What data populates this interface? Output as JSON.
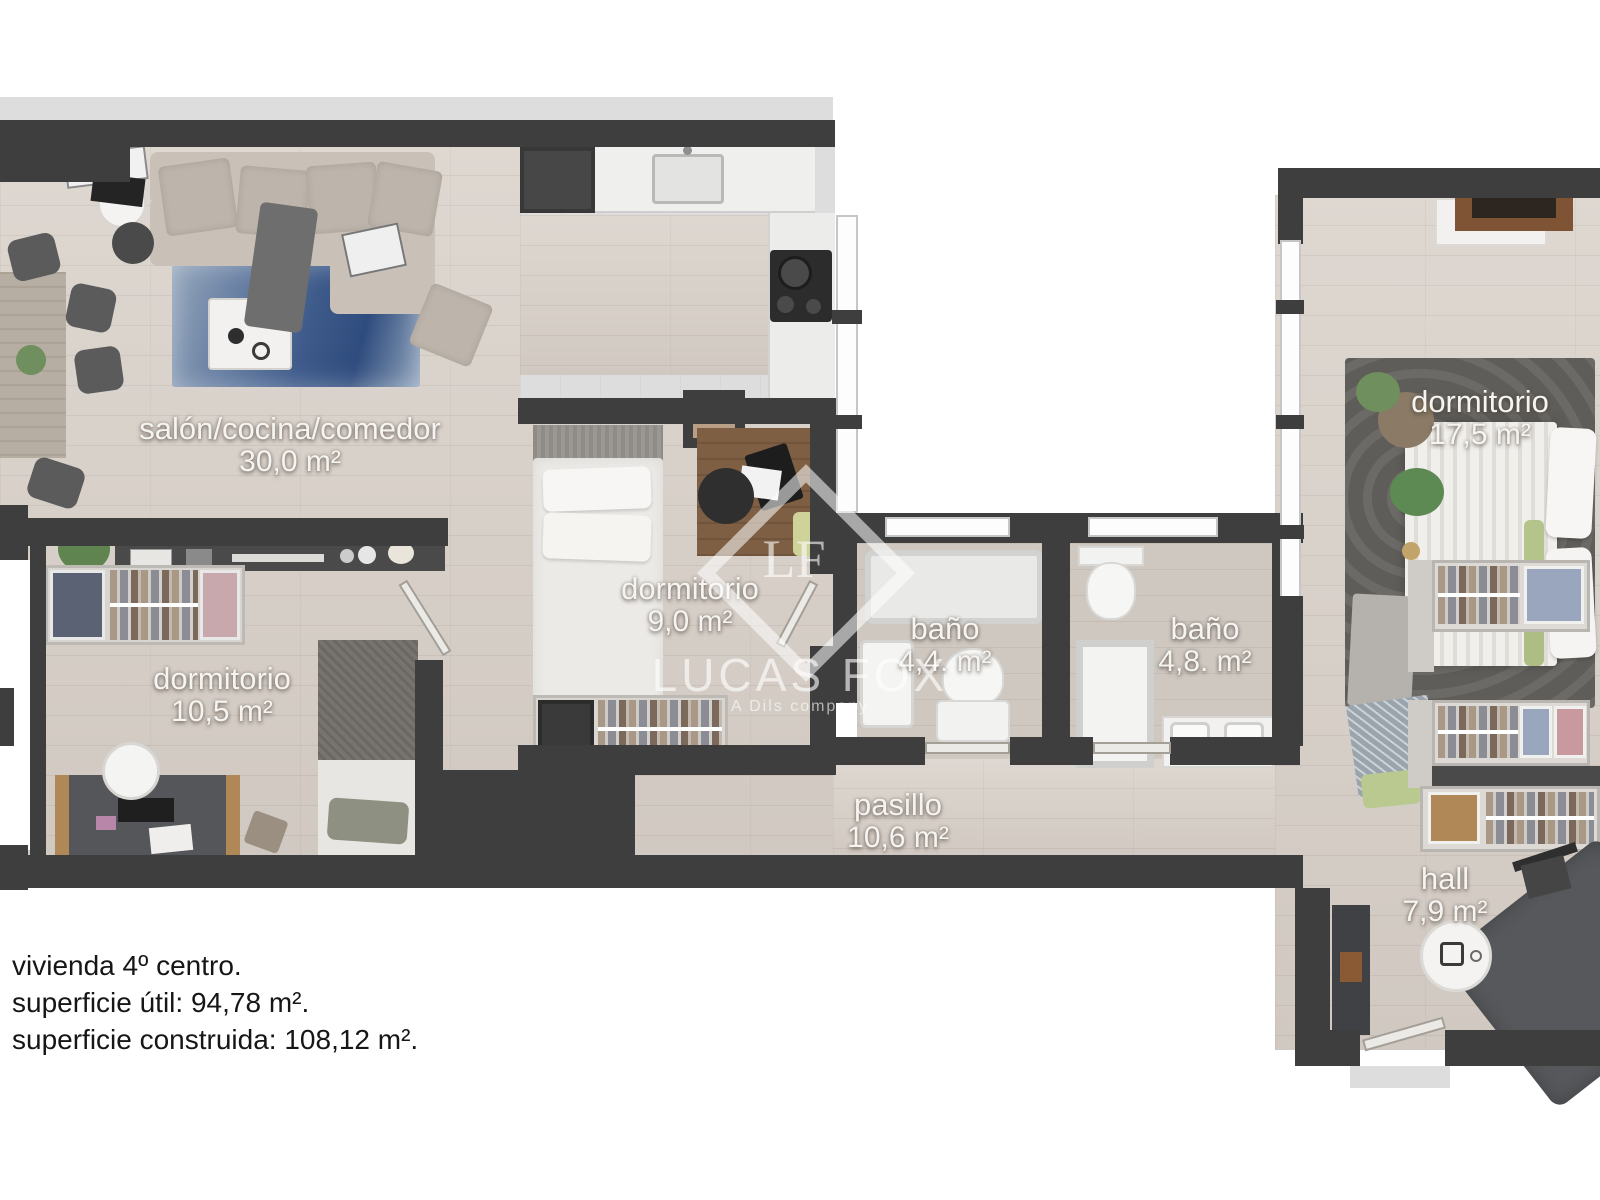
{
  "rooms": [
    {
      "id": "salon",
      "name": "salón/cocina/comedor",
      "area": "30,0 m²"
    },
    {
      "id": "dormitorio-9",
      "name": "dormitorio",
      "area": "9,0 m²"
    },
    {
      "id": "dormitorio-10",
      "name": "dormitorio",
      "area": "10,5 m²"
    },
    {
      "id": "bano-4-4",
      "name": "baño",
      "area": "4,4. m²"
    },
    {
      "id": "bano-4-8",
      "name": "baño",
      "area": "4,8. m²"
    },
    {
      "id": "pasillo",
      "name": "pasillo",
      "area": "10,6 m²"
    },
    {
      "id": "dormitorio-17",
      "name": "dormitorio",
      "area": "17,5 m²"
    },
    {
      "id": "hall",
      "name": "hall",
      "area": "7,9 m²"
    }
  ],
  "footer": {
    "line1": "vivienda 4º centro.",
    "line2": "superficie útil: 94,78 m².",
    "line3": "superficie construida: 108,12 m²."
  },
  "watermark": {
    "monogram": "LF",
    "brand": "LUCAS FOX",
    "sub": "A Dils company"
  },
  "colors": {
    "wall": "#3e3e3e",
    "wood_floor": "#d7cfc7",
    "rug_blue": "#3d5a8a",
    "rug_dark": "#5f5d59",
    "sofa_beige": "#c9c1b7",
    "label_text": "#f6f4f1"
  }
}
